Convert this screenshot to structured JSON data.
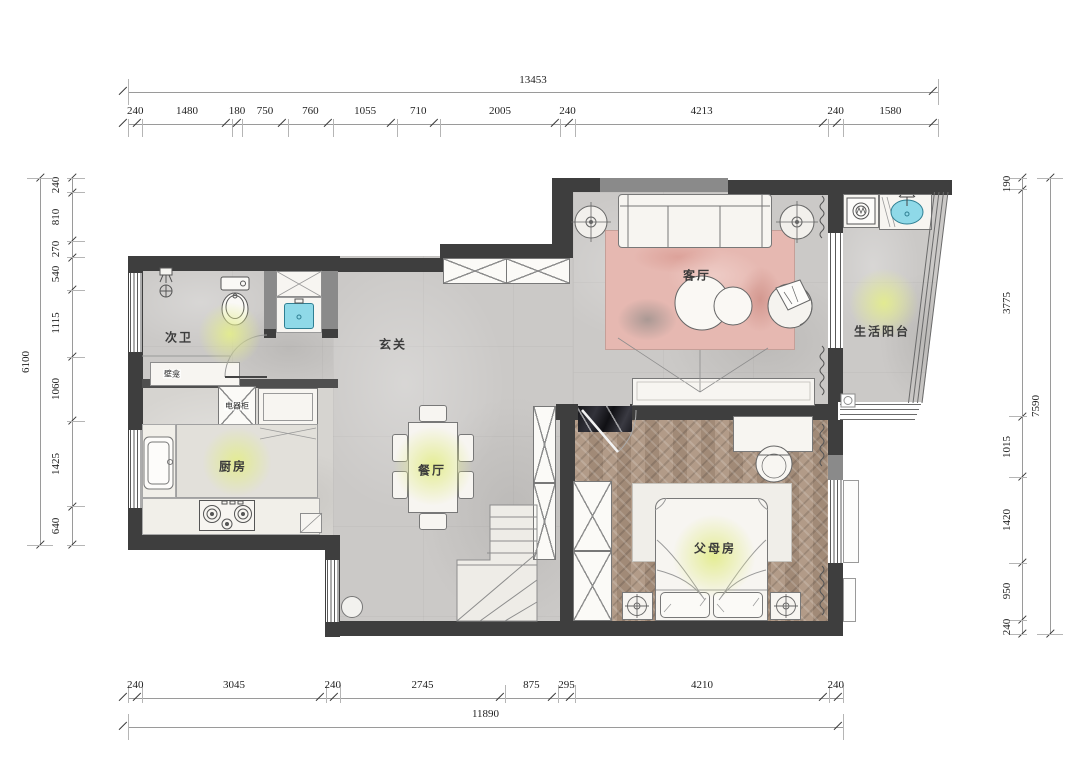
{
  "plan": {
    "rooms": [
      {
        "id": "bathroom",
        "label": "次卫"
      },
      {
        "id": "entry",
        "label": "玄关"
      },
      {
        "id": "living",
        "label": "客厅"
      },
      {
        "id": "balcony",
        "label": "生活阳台"
      },
      {
        "id": "kitchen",
        "label": "厨房"
      },
      {
        "id": "dining",
        "label": "餐厅"
      },
      {
        "id": "parents",
        "label": "父母房"
      }
    ],
    "tags": [
      {
        "id": "niche",
        "label": "壁龛"
      },
      {
        "id": "appliance",
        "label": "电器柜"
      }
    ],
    "fixtures": [
      "toilet-icon",
      "shower-icon",
      "floor-drain-icon",
      "wash-basin-icon",
      "washing-machine-icon",
      "laundry-sink-icon",
      "kitchen-sink-icon",
      "gas-stove-icon",
      "fridge-icon",
      "dining-table-icon",
      "dining-chair-icon",
      "shoe-cabinet-icon",
      "sofa-icon",
      "floor-lamp-icon",
      "coffee-table-icon",
      "armchair-icon",
      "tv-console-icon",
      "stone-feature-wall-icon",
      "bed-icon",
      "pillow-icon",
      "nightstand-icon",
      "table-lamp-icon",
      "wardrobe-icon",
      "closet-icon",
      "desk-icon",
      "desk-chair-icon",
      "stairs-icon",
      "curtain-icon",
      "window-icon",
      "door-swing-icon"
    ]
  },
  "dimensions": {
    "top": {
      "total": "13453",
      "segments": [
        "240",
        "1480",
        "180",
        "750",
        "760",
        "1055",
        "710",
        "2005",
        "240",
        "4213",
        "240",
        "1580"
      ]
    },
    "bottom": {
      "total": "11890",
      "segments": [
        "240",
        "3045",
        "240",
        "2745",
        "875",
        "295",
        "4210",
        "240"
      ]
    },
    "left": {
      "total": "6100",
      "segments": [
        "240",
        "810",
        "270",
        "540",
        "1115",
        "1060",
        "1425",
        "640"
      ]
    },
    "right": {
      "total": "7590",
      "segments": [
        "190",
        "3775",
        "1015",
        "1420",
        "950",
        "240"
      ]
    }
  },
  "colors": {
    "wall": "#3e3e3e",
    "wall_mid": "#8a8a8a",
    "sink_fill": "#8fd9e8",
    "rug_pink": "#e6b8b1",
    "wood_floor": "#ab9481",
    "label_glow": "#e3ec8e"
  }
}
